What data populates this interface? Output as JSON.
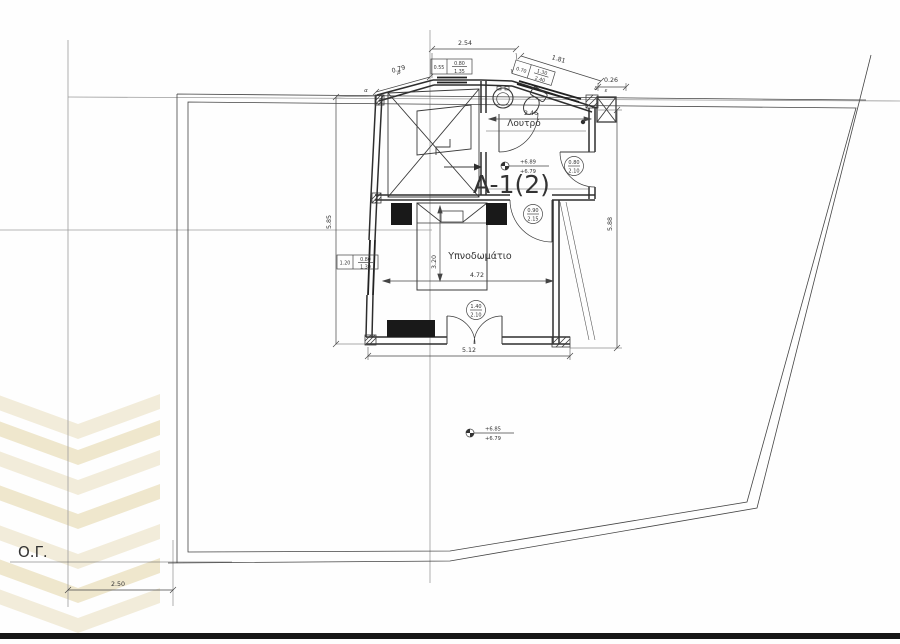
{
  "drawing": {
    "unit_label": "A-1(2)",
    "rooms": {
      "bathroom": "Λουτρό",
      "bedroom": "Υπνοδωμάτιο"
    },
    "site": {
      "building_line": "Ο.Γ.",
      "setback": "2.50"
    },
    "dims": {
      "top": "2.54",
      "nw": "0.79",
      "ne": "1.81",
      "pier": "0.26",
      "bath": "2.46",
      "west": "5.85",
      "east": "5.88",
      "south": "5.12",
      "bed_w": "4.72",
      "bed_d": "3.20"
    },
    "windows": {
      "top": {
        "width": "0.55",
        "sill": "0.80",
        "height": "1.35"
      },
      "ne": {
        "width": "0.70",
        "sill": "1.30",
        "height": "2.40"
      },
      "west": {
        "width": "1.20",
        "sill": "0.80",
        "height": "1.30"
      }
    },
    "doors": {
      "hall": {
        "w": "0.80",
        "h": "2.10"
      },
      "bedroom": {
        "w": "0.90",
        "h": "2.15"
      },
      "balcony": {
        "w": "1.40",
        "h": "2.10"
      }
    },
    "levels": {
      "stair": {
        "upper": "+6.89",
        "lower": "+6.79"
      },
      "terrace": {
        "upper": "+6.85",
        "lower": "+6.79"
      }
    },
    "vertices": {
      "a": "α",
      "b": "β",
      "c": "γ",
      "d": "δ",
      "e": "ε"
    },
    "colors": {
      "ink": "#3a3a3a",
      "axis": "#9c9c9c",
      "watermark": "#f2ecda",
      "watermark_alt": "#efe7cd"
    }
  }
}
